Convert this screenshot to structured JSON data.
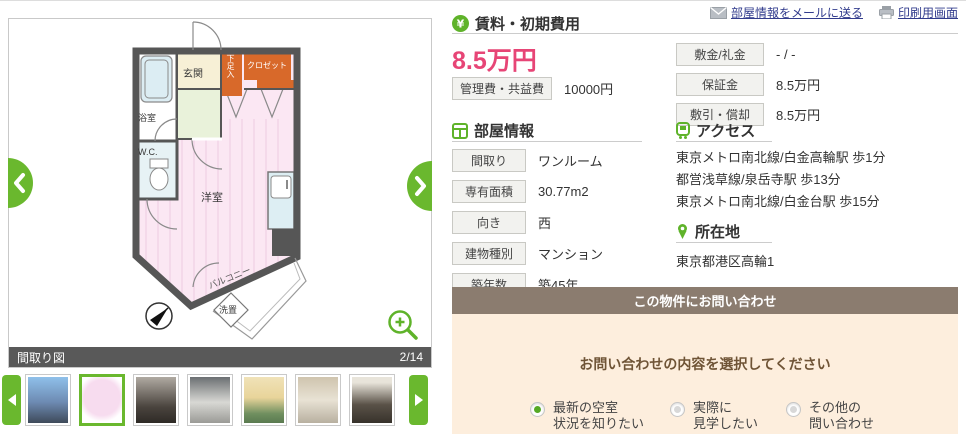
{
  "colors": {
    "accent_green": "#6ab82e",
    "price_pink": "#e74576",
    "link_blue": "#323c8d",
    "caption_bar_gray": "#595959",
    "inquiry_header_brown": "#8b7c6f",
    "inquiry_body_peach": "#fdeedd",
    "closet_orange": "#d8692a",
    "room_pink": "#fbe7f3"
  },
  "icons": {
    "mail": "mail-envelope-icon",
    "print": "printer-icon",
    "yen": "yen-circle-icon",
    "room": "room-grid-icon",
    "train": "train-icon",
    "pin": "map-pin-icon",
    "zoom": "magnifier-plus-icon",
    "prev": "chevron-left-icon",
    "next": "chevron-right-icon",
    "compass": "compass-north-icon"
  },
  "header_links": {
    "mail": "部屋情報をメールに送る",
    "print": "印刷用画面"
  },
  "gallery": {
    "caption": "間取り図",
    "counter": "2/14",
    "floorplan": {
      "genkan": "玄関",
      "shoe_box": "下足入",
      "closet": "クロゼット",
      "bathroom": "浴室",
      "wc": "W.C.",
      "main_room": "洋室",
      "balcony": "バルコニー",
      "laundry": "洗置"
    },
    "thumbnails": [
      {
        "name": "building-exterior",
        "selected": false
      },
      {
        "name": "floor-plan",
        "selected": true
      },
      {
        "name": "room-interior-dark",
        "selected": false
      },
      {
        "name": "kitchen",
        "selected": false
      },
      {
        "name": "hallway",
        "selected": false
      },
      {
        "name": "toilet",
        "selected": false
      },
      {
        "name": "room-interior",
        "selected": false
      }
    ]
  },
  "rent": {
    "section_title": "賃料・初期費用",
    "price": "8.5万円",
    "management_fee_label": "管理費・共益費",
    "management_fee_value": "10000円",
    "details": [
      {
        "label": "敷金/礼金",
        "value": "- / -"
      },
      {
        "label": "保証金",
        "value": "8.5万円"
      },
      {
        "label": "敷引・償却",
        "value": "8.5万円"
      }
    ]
  },
  "room_info": {
    "section_title": "部屋情報",
    "rows": [
      {
        "label": "間取り",
        "value": "ワンルーム"
      },
      {
        "label": "専有面積",
        "value": "30.77m2"
      },
      {
        "label": "向き",
        "value": "西"
      },
      {
        "label": "建物種別",
        "value": "マンション"
      },
      {
        "label": "築年数",
        "value": "築45年"
      }
    ]
  },
  "access": {
    "section_title": "アクセス",
    "lines": [
      "東京メトロ南北線/白金高輪駅 歩1分",
      "都営浅草線/泉岳寺駅 歩13分",
      "東京メトロ南北線/白金台駅 歩15分"
    ]
  },
  "location": {
    "section_title": "所在地",
    "address": "東京都港区高輪1"
  },
  "inquiry": {
    "title": "この物件にお問い合わせ",
    "prompt": "お問い合わせの内容を選択してください",
    "options": [
      {
        "line1": "最新の空室",
        "line2": "状況を知りたい",
        "selected": true
      },
      {
        "line1": "実際に",
        "line2": "見学したい",
        "selected": false
      },
      {
        "line1": "その他の",
        "line2": "問い合わせ",
        "selected": false
      }
    ]
  }
}
